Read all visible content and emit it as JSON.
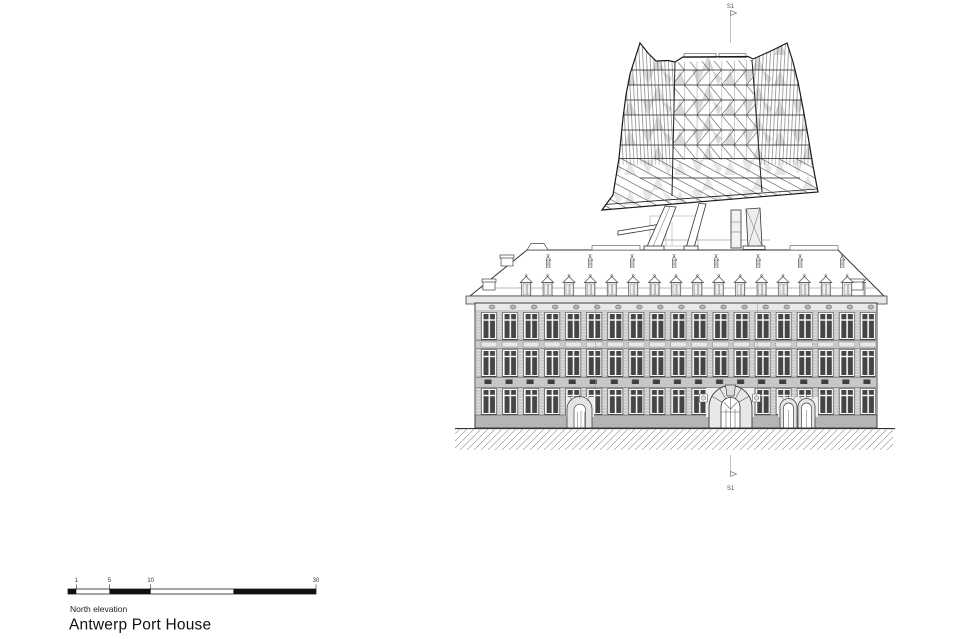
{
  "titleblock": {
    "subtitle": "North elevation",
    "title": "Antwerp Port House"
  },
  "scalebar": {
    "tick_labels": [
      "1",
      "5",
      "10",
      "30"
    ]
  },
  "section_marker": {
    "top_label": "S1",
    "bottom_label": "S1"
  },
  "colors": {
    "line": "#2a2a2a",
    "light_line": "#8a8a8a",
    "glass_shade": "#d9d9d9",
    "facade_fill": "#efefef",
    "pier_fill": "#dcdcdc",
    "band_fill": "#c9c9c9",
    "glazing_fill": "#454545",
    "plinth_fill": "#b5b5b5",
    "background": "#ffffff"
  },
  "drawing": {
    "label": "Antwerp Port House north elevation"
  }
}
